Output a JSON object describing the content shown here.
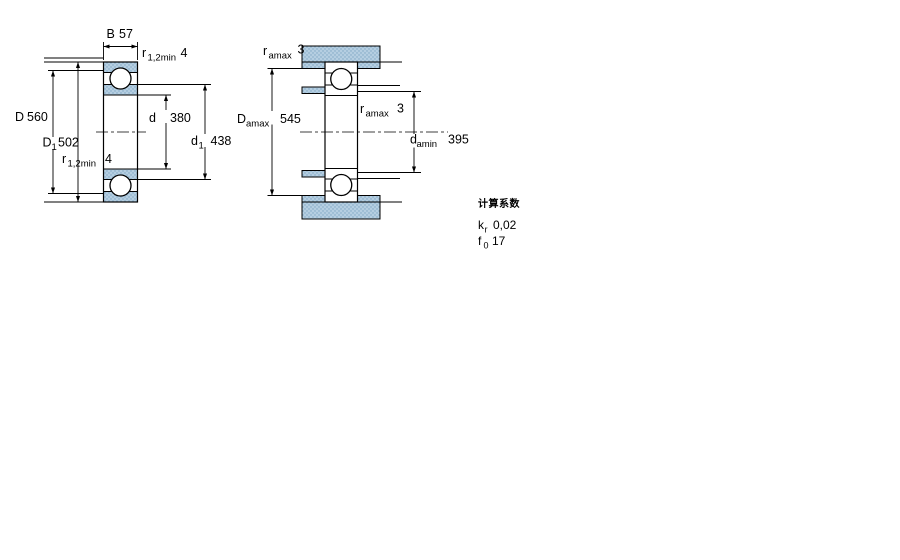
{
  "figure": {
    "description_left": "bearing-cross-section",
    "description_right": "abutment-dimensions-section"
  },
  "dims": {
    "B": {
      "sym": "B",
      "val": "57"
    },
    "r12_top": {
      "sym": "r",
      "sub": "1,2min",
      "val": "4"
    },
    "r12_bot": {
      "sym": "r",
      "sub": "1,2min",
      "val": "4"
    },
    "D": {
      "sym": "D",
      "val": "560"
    },
    "D1": {
      "sym": "D",
      "sub": "1",
      "val": "502"
    },
    "d": {
      "sym": "d",
      "val": "380"
    },
    "d1": {
      "sym": "d",
      "sub": "1",
      "val": "438"
    },
    "ra_top": {
      "sym": "r",
      "sub": "amax",
      "val": "3"
    },
    "ra_mid": {
      "sym": "r",
      "sub": "amax",
      "val": "3"
    },
    "Da": {
      "sym": "D",
      "sub": "amax",
      "val": "545"
    },
    "da": {
      "sym": "d",
      "sub": "amin",
      "val": "395"
    }
  },
  "factors": {
    "title": "计算系数",
    "kr": {
      "sym": "k",
      "sub": "r",
      "val": "0,02"
    },
    "f0": {
      "sym": "f",
      "sub": "0",
      "val": "17"
    }
  },
  "colors": {
    "ring_fill": "#b5cee1",
    "speckle_dot": "#7ea6c4",
    "line": "#000000",
    "background": "#ffffff"
  }
}
